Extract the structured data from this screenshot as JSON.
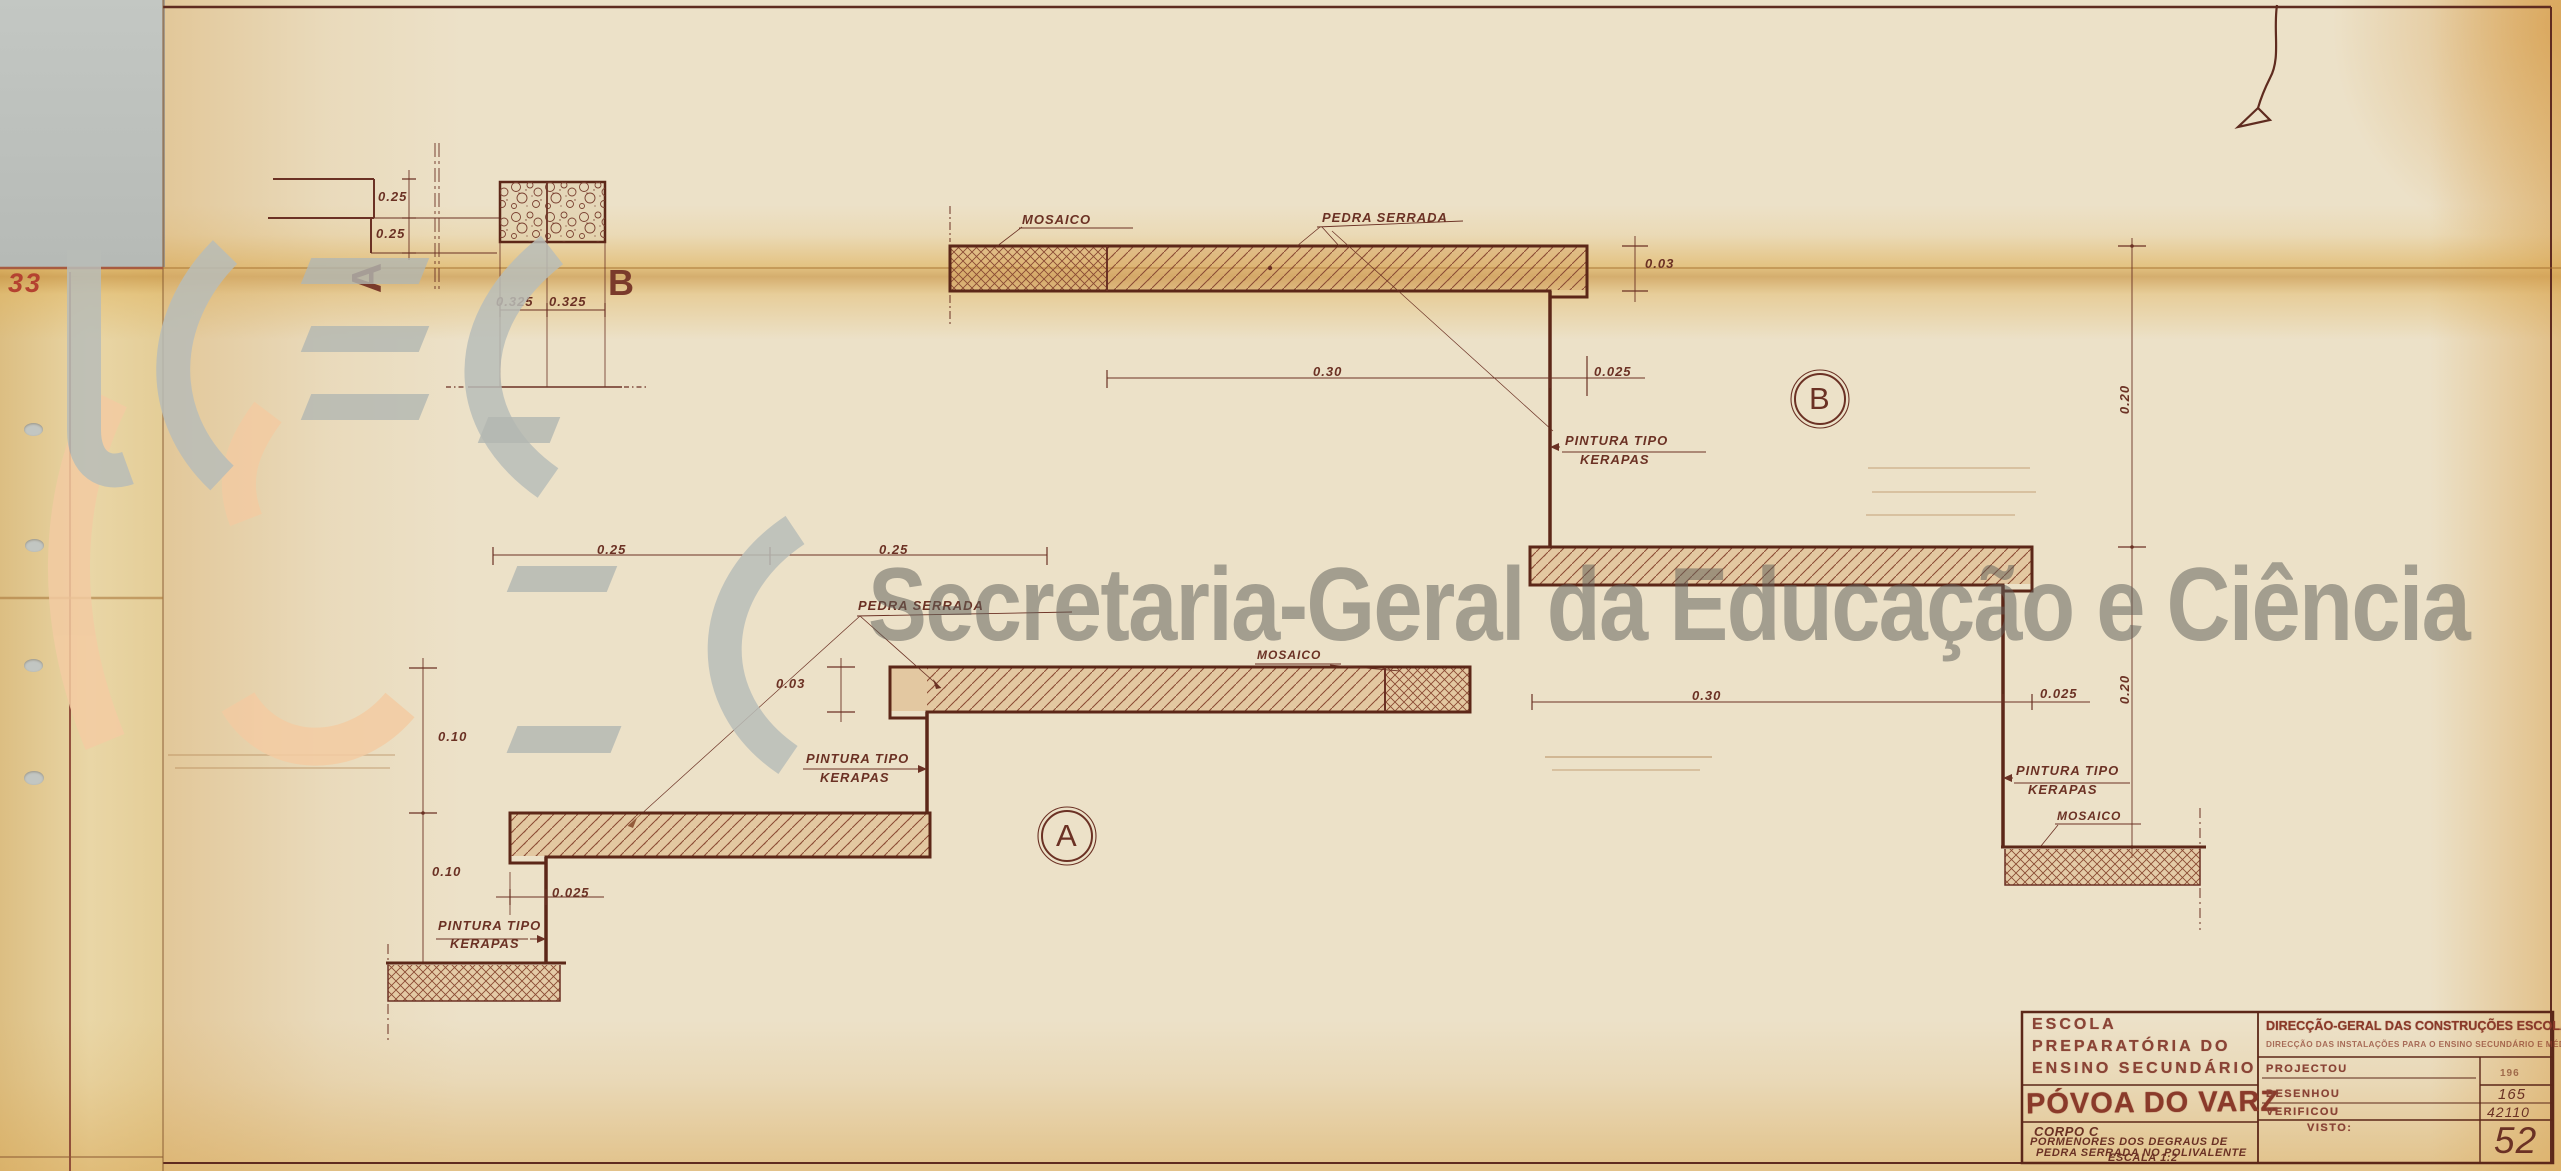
{
  "margin": {
    "sheet_number": "33"
  },
  "watermark": {
    "text": "Secretaria-Geral da Educação e Ciência"
  },
  "plan_detail": {
    "label_a": "A",
    "label_b": "B",
    "dims": {
      "riser_1": "0.25",
      "riser_2": "0.25",
      "tread_1": "0.325",
      "tread_2": "0.325"
    }
  },
  "section_a": {
    "label": "A",
    "labels": {
      "pedra_serrada": "PEDRA SERRADA",
      "mosaico_top": "MOSAICO",
      "pintura_1_line1": "PINTURA TIPO",
      "pintura_1_line2": "KERAPAS",
      "pintura_2_line1": "PINTURA TIPO",
      "pintura_2_line2": "KERAPAS"
    },
    "dims": {
      "tread_1": "0.25",
      "tread_2": "0.25",
      "thickness": "0.03",
      "riser_1": "0.10",
      "riser_2": "0.10",
      "nosing": "0.025"
    }
  },
  "section_b": {
    "label": "B",
    "labels": {
      "mosaico_top": "MOSAICO",
      "pedra_serrada": "PEDRA SERRADA",
      "pintura_1_line1": "PINTURA TIPO",
      "pintura_1_line2": "KERAPAS",
      "pintura_2_line1": "PINTURA TIPO",
      "pintura_2_line2": "KERAPAS",
      "mosaico_floor": "MOSAICO"
    },
    "dims": {
      "thickness": "0.03",
      "tread_1": "0.30",
      "nosing_1": "0.025",
      "riser_1": "0.20",
      "tread_2": "0.30",
      "nosing_2": "0.025",
      "riser_2": "0.20"
    }
  },
  "title_block": {
    "school_line1": "ESCOLA",
    "school_line2": "PREPARATÓRIA DO",
    "school_line3": "ENSINO SECUNDÁRIO",
    "location_stamp": "PÓVOA DO VARZIM",
    "body": "CORPO C",
    "subject_line1": "PORMENORES DOS DEGRAUS DE",
    "subject_line2": "PEDRA SERRADA NO POLIVALENTE",
    "scale": "ESCALA 1:2",
    "agency": "DIRECÇÃO-GERAL DAS CONSTRUÇÕES ESCOLARES",
    "agency_sub": "DIRECÇÃO DAS INSTALAÇÕES PARA O ENSINO SECUNDÁRIO E MÉDIO",
    "row_projectou": "PROJECTOU",
    "row_desenhou": "DESENHOU",
    "row_verificou": "VERIFICOU",
    "row_visto": "VISTO:",
    "num_printed": "196",
    "num_desenhou": "165",
    "num_process": "42110",
    "sheet_number": "52"
  }
}
